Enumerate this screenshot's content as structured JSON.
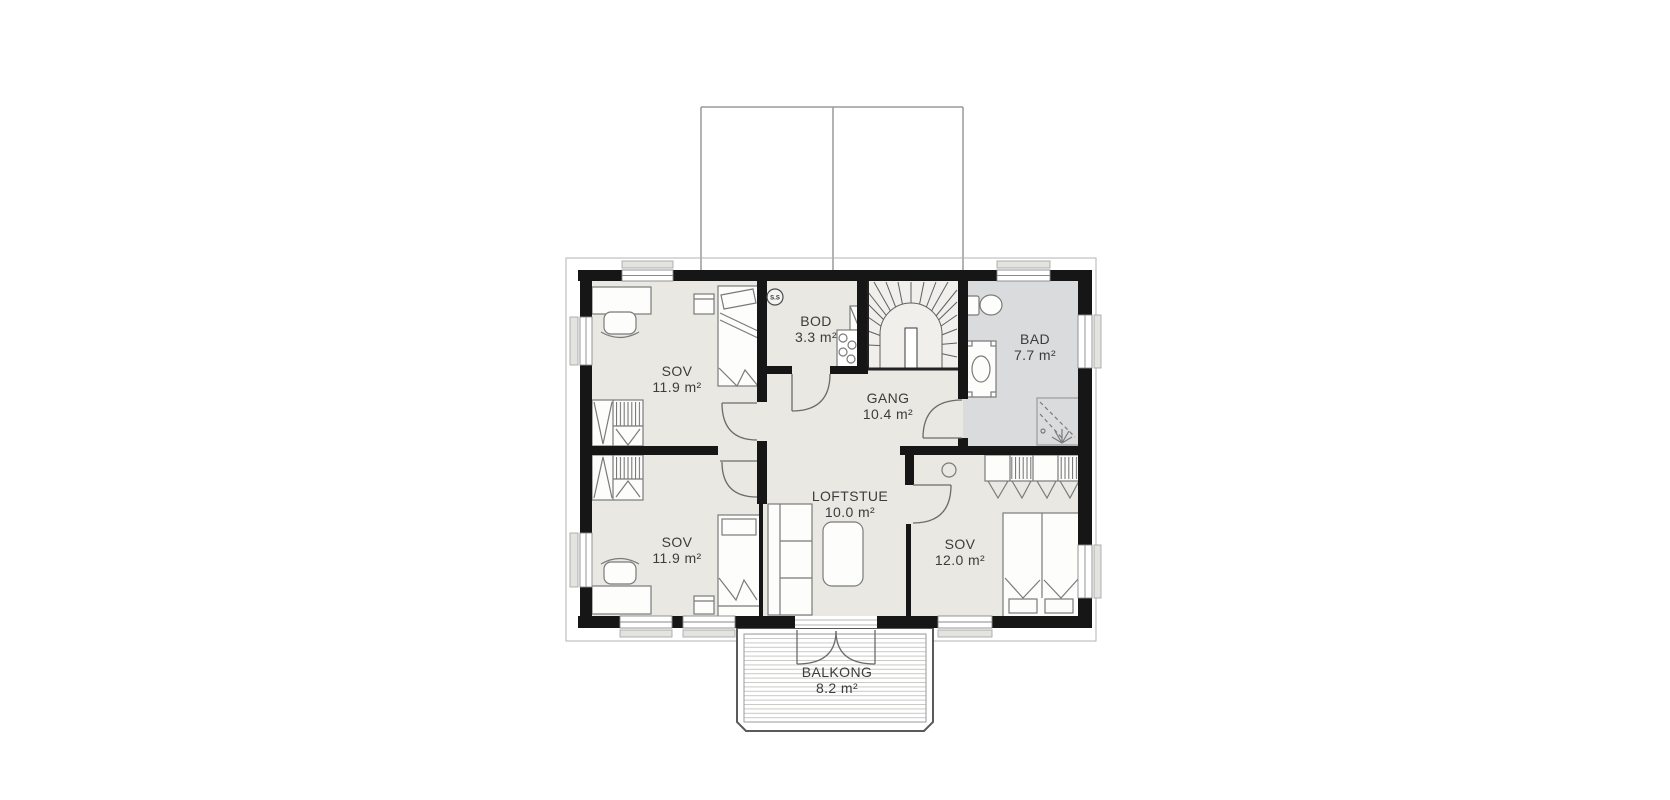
{
  "floorplan": {
    "rooms": [
      {
        "name": "SOV",
        "area": "11.9 m²"
      },
      {
        "name": "BOD",
        "area": "3.3 m²"
      },
      {
        "name": "GANG",
        "area": "10.4 m²"
      },
      {
        "name": "BAD",
        "area": "7.7 m²"
      },
      {
        "name": "SOV",
        "area": "11.9 m²"
      },
      {
        "name": "LOFTSTUE",
        "area": "10.0 m²"
      },
      {
        "name": "SOV",
        "area": "12.0 m²"
      },
      {
        "name": "BALKONG",
        "area": "8.2 m²"
      }
    ],
    "symbols": {
      "detector_label": "S.S"
    },
    "colors": {
      "wall": "#161616",
      "floor": "#e9e8e2",
      "bath_floor": "#dadbdd",
      "stair_floor": "#f0efeb",
      "text": "#3c3c3c",
      "furniture_stroke": "#7a7a7a"
    }
  }
}
